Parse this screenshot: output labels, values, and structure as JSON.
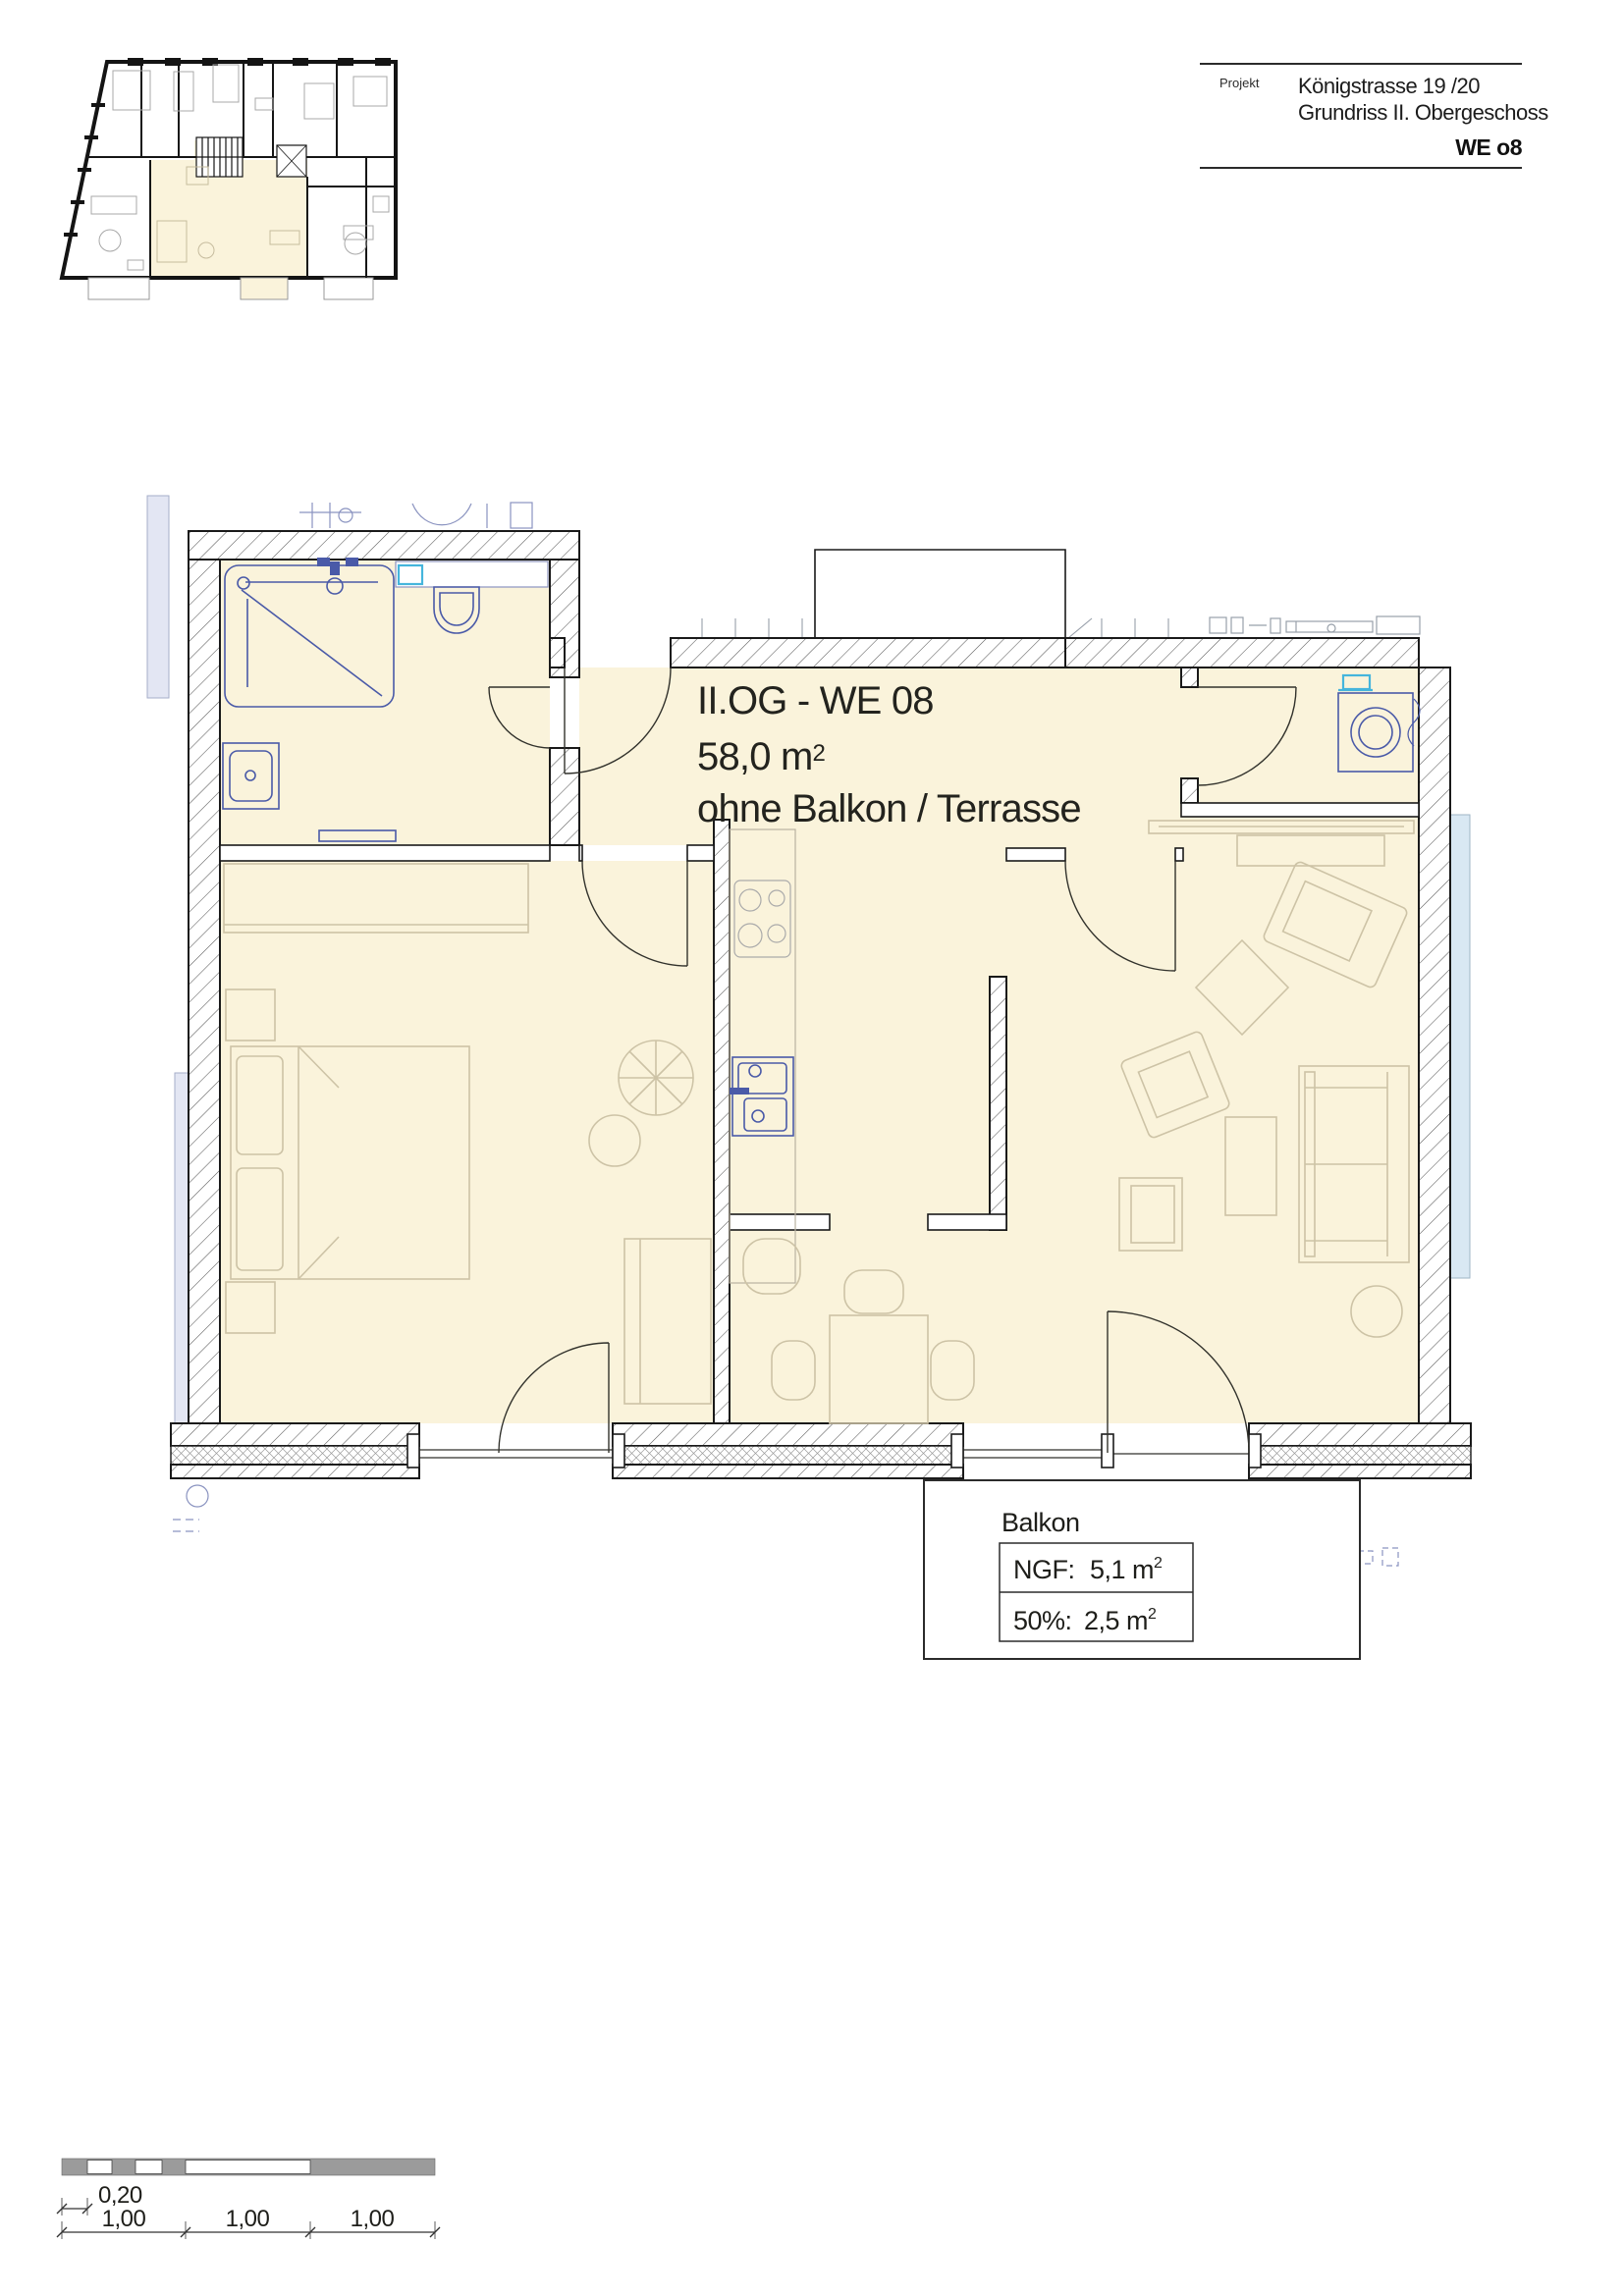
{
  "title_block": {
    "field_label": "Projekt",
    "project_line1": "Königstrasse 19 /20",
    "project_line2": "Grundriss II. Obergeschoss",
    "unit_label": "WE o8"
  },
  "plan_label": {
    "line1": "II.OG - WE 08",
    "area_main": "58,0 m",
    "area_sup": "2",
    "line3": "ohne Balkon / Terrasse"
  },
  "balcony_annotation": {
    "title": "Balkon",
    "rows": [
      {
        "label": "NGF:",
        "value": "5,1 m",
        "sup": "2"
      },
      {
        "label": "50%:",
        "value": "2,5 m",
        "sup": "2"
      }
    ]
  },
  "scale_bar": {
    "offset_label": "0,20",
    "segment_labels": [
      "1,00",
      "1,00",
      "1,00"
    ]
  },
  "colors": {
    "room_fill": "#faf3db",
    "wall_line": "#1a1a1a",
    "fixture_blue": "#4a5aa8",
    "fixture_cyan": "#45b5dc",
    "furniture_tan": "#cdc3a6",
    "neighbor_grey": "#98a0aa",
    "neighbor_lavender": "#e3e6f3",
    "neighbor_skyblue": "#d9e8f3",
    "scalebar_grey": "#9b9b9b"
  }
}
